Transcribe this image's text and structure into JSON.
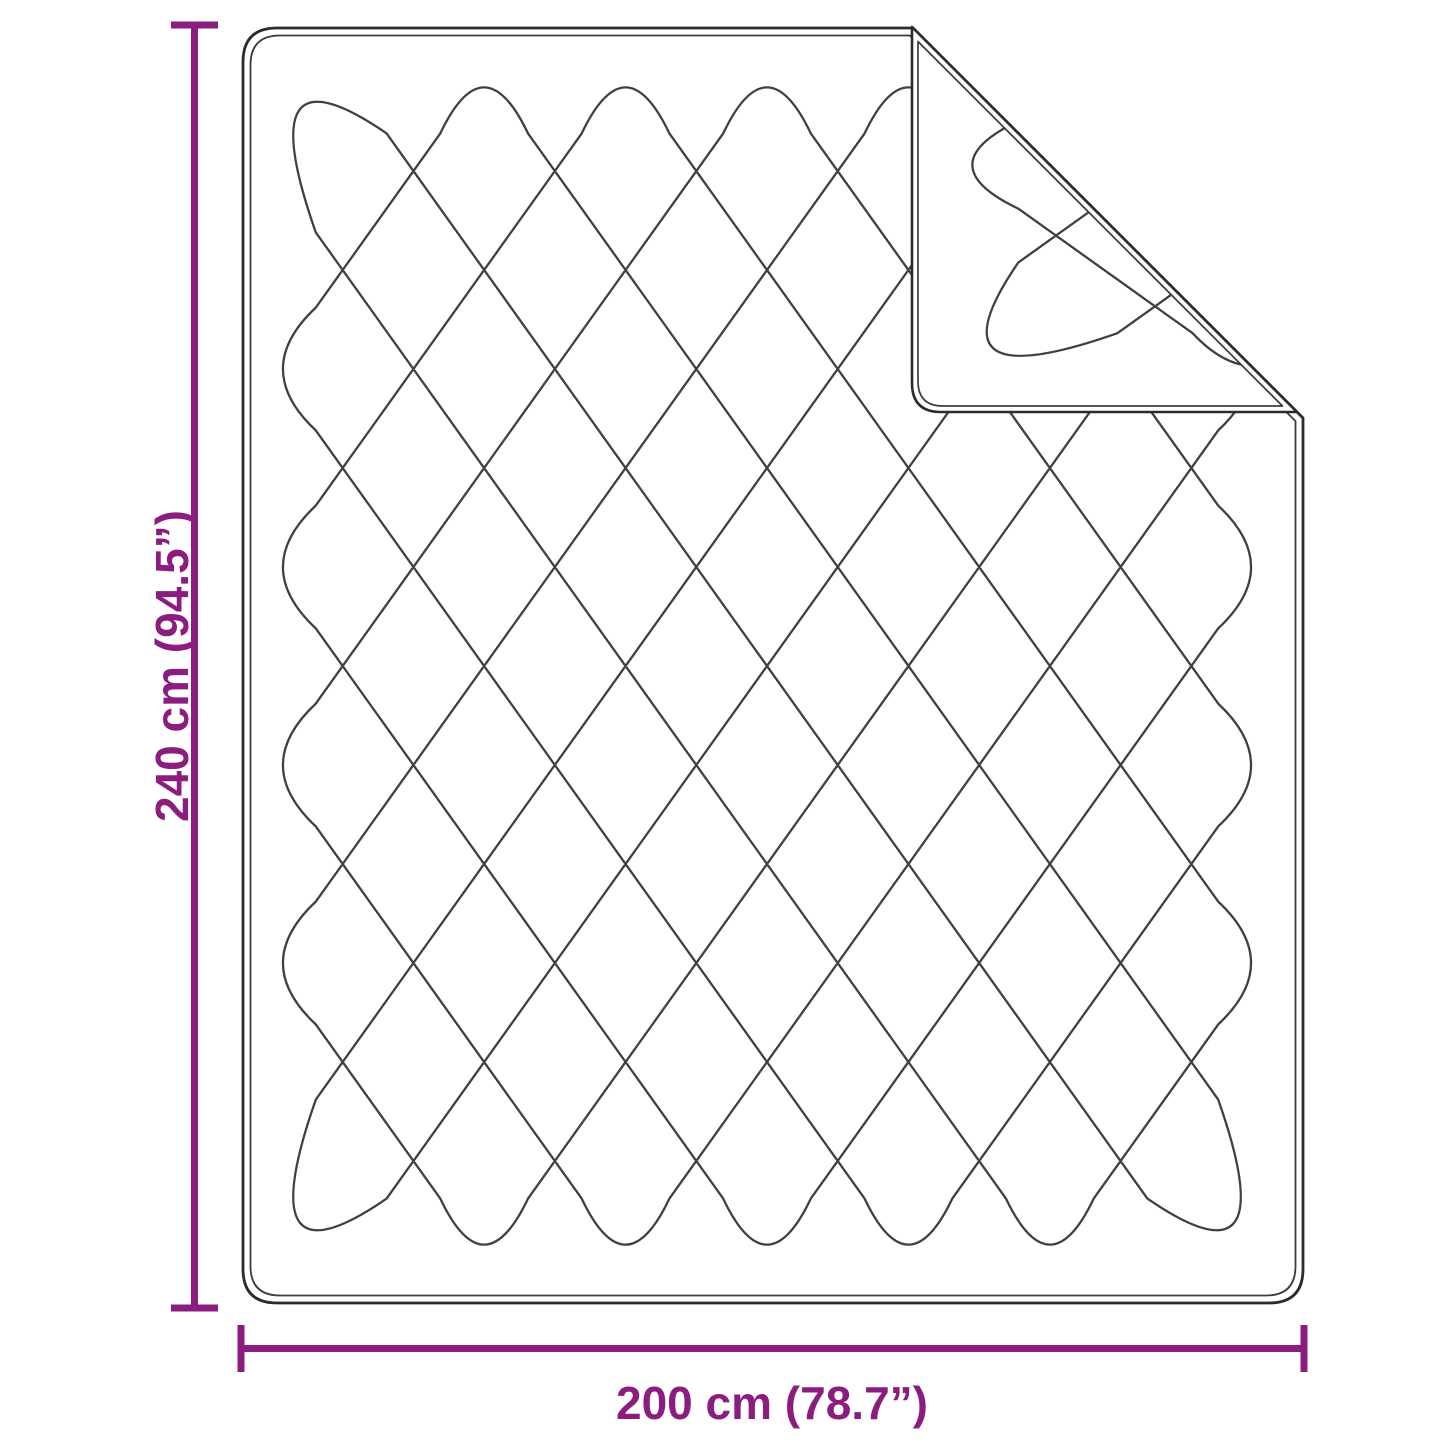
{
  "figure": {
    "kind": "product-dimension-diagram",
    "product": "quilted-blanket-with-folded-corner",
    "colors": {
      "background": "#ffffff",
      "outline": "#2b2b2b",
      "outline_inner": "#3c3c3c",
      "quilt_line": "#404040",
      "dimension_accent": "#8b1d7f"
    }
  },
  "dimensions": {
    "height": {
      "label": "240 cm (94.5”)",
      "value_cm": "240",
      "value_in": "94.5"
    },
    "width": {
      "label": "200 cm (78.7”)",
      "value_cm": "200",
      "value_in": "78.7"
    }
  }
}
